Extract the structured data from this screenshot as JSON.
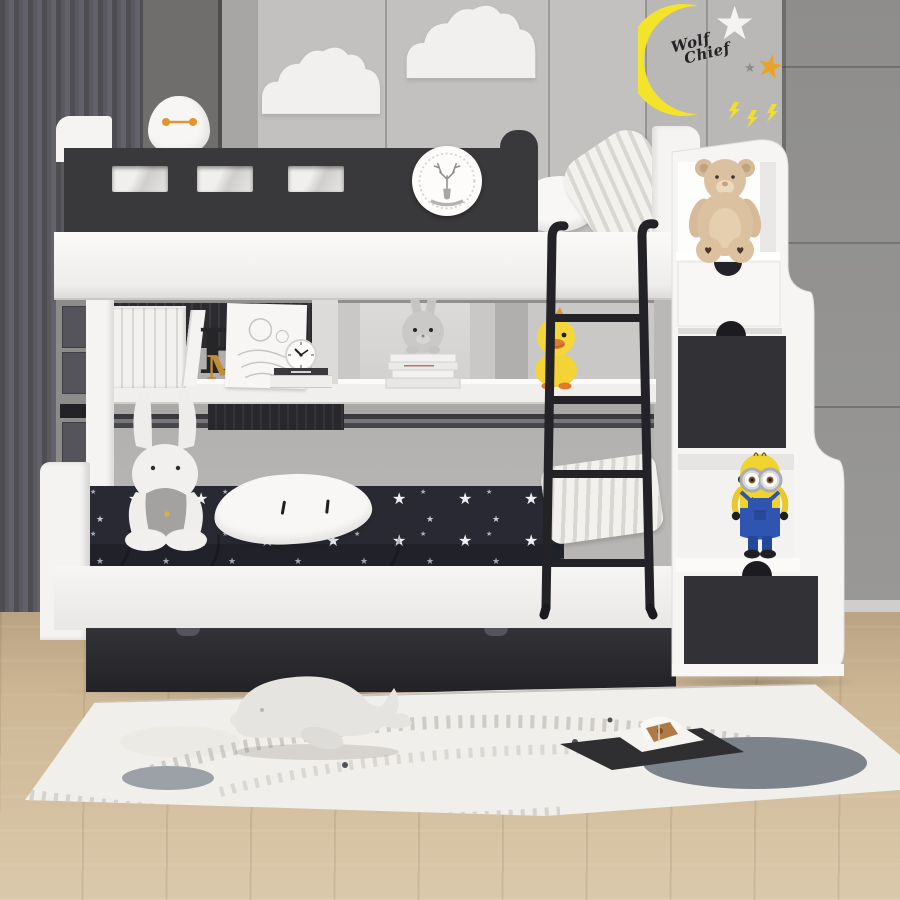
{
  "scene": {
    "description": "Children's bedroom with a black-and-white bunk bed, staircase storage drawers, toys, star bedding and a play rug on a wood floor",
    "wall_decals": {
      "moon_text_line1": "Wolf",
      "moon_text_line2": "Chief"
    },
    "shelf_letters": {
      "letter_e": "E",
      "letter_m": "M"
    },
    "colors": {
      "wall": "#c2c1bf",
      "wall_right_wardrobe": "#929190",
      "curtain": "#55545a",
      "bed_white": "#f5f4f2",
      "accent_black": "#39383a",
      "bedding_navy": "#292a32",
      "moon_yellow": "#f3e32a",
      "star_orange": "#e9a32b",
      "minion_yellow": "#f1d32e",
      "minion_blue": "#2f55b0",
      "duck_yellow": "#f6d73b",
      "teddy_tan": "#dcc1a0",
      "floor_wood": "#d0bb9b",
      "rug": "#f1efeb"
    },
    "objects": [
      "crescent moon decal",
      "cloud wall decals",
      "star decals",
      "lightning decals",
      "bunk bed with black guardrail",
      "deer plaque",
      "baymax plush",
      "ladder",
      "staircase storage drawers",
      "teddy bear",
      "minion figure",
      "duck plush",
      "shelf bunny on book stack",
      "large rabbit plush",
      "star pattern bedding",
      "white pillows",
      "trundle drawer",
      "wall clock",
      "sketch print",
      "shelf books",
      "play rug with train track pattern",
      "whale plush",
      "open picture book"
    ]
  }
}
